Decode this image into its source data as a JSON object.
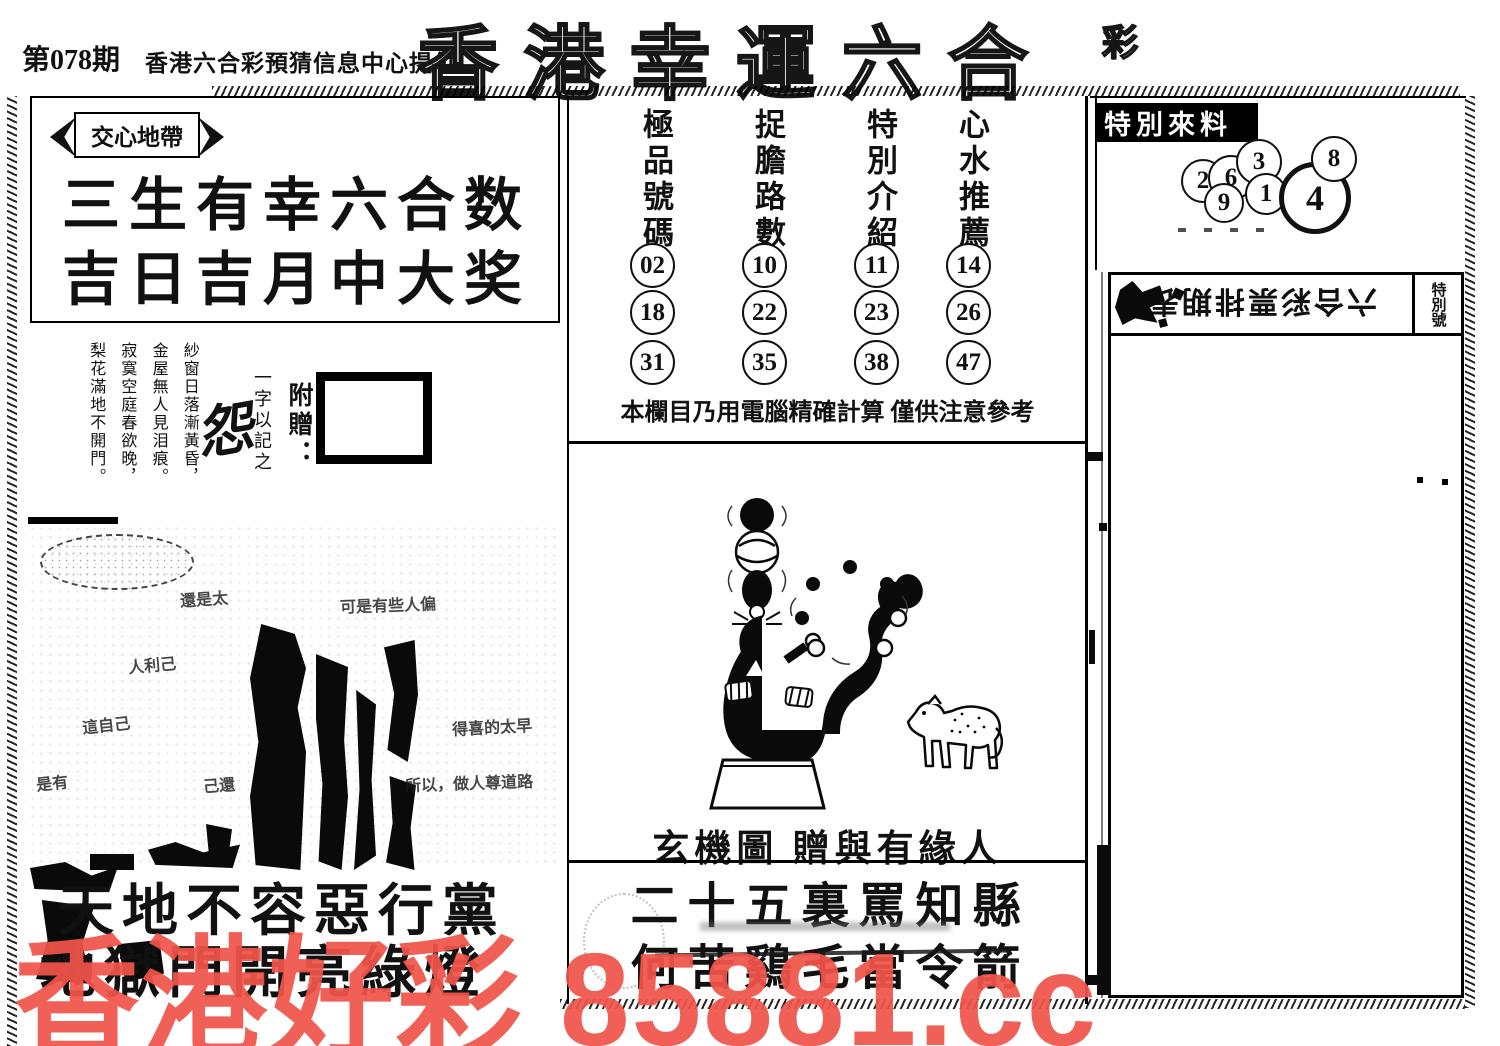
{
  "header": {
    "issue": "第078期",
    "provider": "香港六合彩預猜信息中心提供",
    "title": "香港幸運六合",
    "title_suffix": "彩"
  },
  "heart_zone": {
    "ribbon": "交心地帶",
    "slogan_line1": "三生有幸六合数",
    "slogan_line2": "吉日吉月中大奖"
  },
  "poem": {
    "lines": [
      "紗窗日落漸黃昏，",
      "金屋無人見泪痕。",
      "寂寞空庭春欲晚，",
      "梨花滿地不開門。"
    ],
    "summary_note": "一字以記之",
    "summary_char": "怨",
    "gift_label": "附贈："
  },
  "fragments": {
    "items": [
      "還是太",
      "可是有些人偏",
      "人利己",
      "這自己",
      "得喜的太早",
      "所以，做人尊道路",
      "是有",
      "己還"
    ]
  },
  "left_verse": {
    "line1": "天地不容惡行黨",
    "line2": "地獄門開亮綠燈"
  },
  "number_table": {
    "columns": [
      {
        "header": "極品號碼",
        "numbers": [
          "02",
          "18",
          "31"
        ]
      },
      {
        "header": "捉膽路數",
        "numbers": [
          "10",
          "22",
          "35"
        ]
      },
      {
        "header": "特別介紹",
        "numbers": [
          "11",
          "23",
          "38"
        ]
      },
      {
        "header": "心水推薦",
        "numbers": [
          "14",
          "26",
          "47"
        ]
      }
    ],
    "note": "本欄目乃用電腦精確計算 僅供注意參考"
  },
  "mystery": {
    "caption": "玄機圖 贈與有緣人",
    "verse_line1": "二十五裏罵知縣",
    "verse_line2": "何苦鷄毛當令箭"
  },
  "special_feed": {
    "label": "特別來料",
    "numbers": [
      "2",
      "6",
      "3",
      "9",
      "1",
      "4",
      "8"
    ],
    "highlight": "4"
  },
  "schedule": {
    "title": "六合彩票排期表",
    "corner_label": "特別號"
  },
  "watermark": {
    "text": "香港好彩 85881.cc",
    "color": "#f1544a"
  }
}
